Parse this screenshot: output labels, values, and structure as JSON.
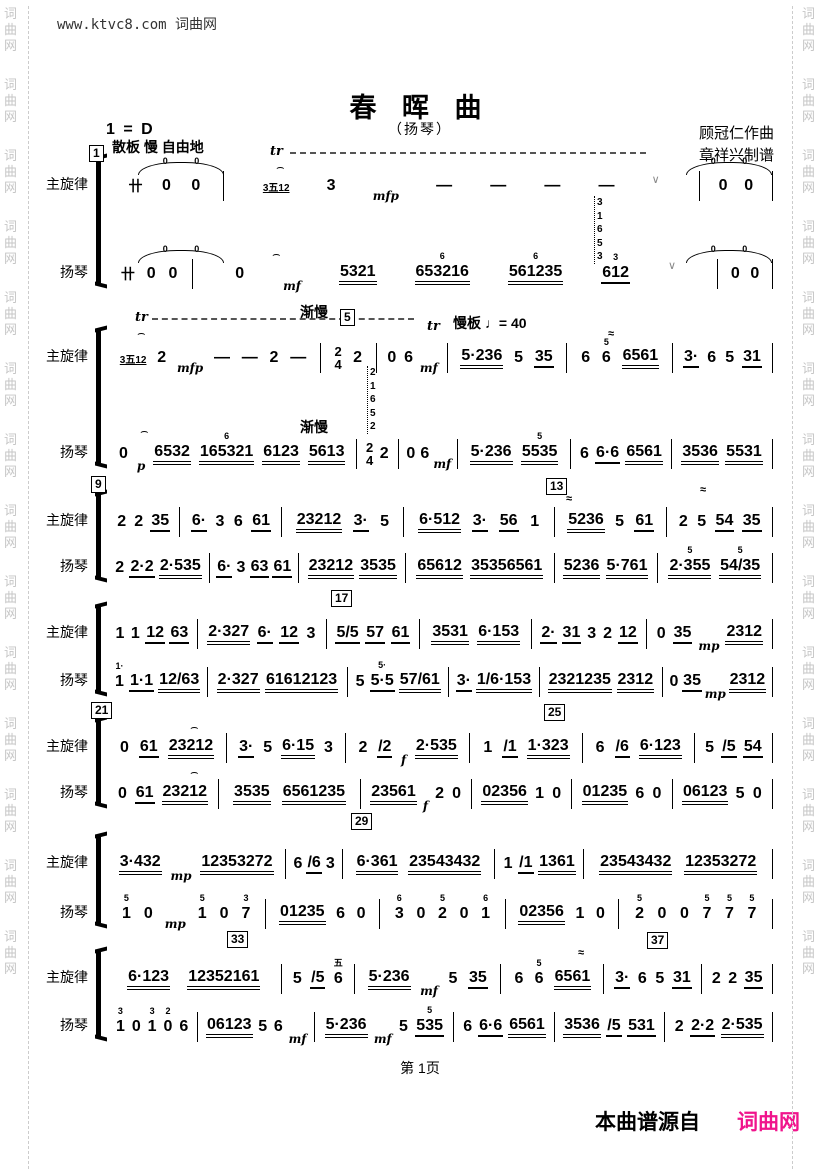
{
  "header": {
    "site_url": "www.ktvc8.com 词曲网",
    "title": "春 晖 曲",
    "subtitle": "（扬琴）",
    "composer": "顾冠仁作曲",
    "arranger": "章祥兴制谱",
    "key_signature": "1 = D"
  },
  "watermark": {
    "text": "词曲网"
  },
  "parts": {
    "top": "主旋律",
    "bottom": "扬琴"
  },
  "systems": [
    {
      "top": [
        "卄 0 0",
        "G:3五12 3 mfp — — — — ∨",
        "0 0"
      ],
      "bottom": [
        "卄 0 0",
        "0 mf 5321 653216^6 561235^6 612^3 ∨",
        "0 0"
      ]
    },
    {
      "top": [
        "G:3五12 2 mfp — — 2 —",
        "TS:2/4 2",
        "0 6 mf",
        "5·236 5 35",
        "6 6^5 6561",
        "3· 6 5 31"
      ],
      "bottom": [
        "0 p 6532 165321^6 6123 5613",
        "TS:2/4 2",
        "0 6 mf",
        "5·236 5535^5",
        "6 6·6 6561",
        "3536 5531"
      ]
    },
    {
      "top": [
        "2 2 35",
        "6· 3 6 61",
        "23212 3· 5",
        "6·512 3· 56 1",
        "5236 5 61",
        "2 5 54 35"
      ],
      "bottom": [
        "2 2·2 2·535",
        "6· 3 63 61",
        "23212 3535",
        "65612 35356561",
        "5236 5·761",
        "2·355^5 54/35^5"
      ]
    },
    {
      "top": [
        "1 1 12 63",
        "2·327 6· 12 3",
        "5/5 57 61",
        "3531 6·153",
        "2· 31 3 2 12",
        "0 35 mp 2312"
      ],
      "bottom": [
        "1^1· 1·1 12/63",
        "2·327 61612123",
        "5 5·5^5· 57/61",
        "3· 1/6·153",
        "2321235 2312",
        "0 35 mp 2312"
      ]
    },
    {
      "top": [
        "0 61 23212",
        "3· 5 6·15 3",
        "2 /2 f 2·535",
        "1 /1 1·323",
        "6 /6 6·123",
        "5 /5 54"
      ],
      "bottom": [
        "0 61 23212",
        "3535 6561235",
        "23561 f 2 0",
        "02356 1 0",
        "01235 6 0",
        "06123 5 0"
      ]
    },
    {
      "top": [
        "3·432 mp 12353272",
        "6 /6 3",
        "6·361 23543432",
        "1 /1 1361",
        "23543432 12353272"
      ],
      "bottom": [
        "1^5 0 mp 1^5 0 7^3",
        "01235 6 0",
        "3^6 0 2^5 0 1^6",
        "02356 1 0",
        "2^5 0 0 7^5 7^5 7^5"
      ]
    },
    {
      "top": [
        "6·123 12352161",
        "5 /5 6^五",
        "5·236 mf 5 35",
        "6 6^5 6561",
        "3· 6 5 31",
        "2 2 35"
      ],
      "bottom": [
        "1^3 0 1^3 0^2 6",
        "06123 5 6 mf",
        "5·236 mf 5 535^5",
        "6 6·6 6561",
        "3536 /5 531",
        "2 2·2 2·535"
      ]
    }
  ],
  "marks": [
    {
      "cls": "box",
      "t": "1",
      "x": 89,
      "y": 145
    },
    {
      "cls": "tempo",
      "t": "散板 慢 自由地",
      "x": 112,
      "y": 137
    },
    {
      "cls": "tr",
      "t": "tr",
      "x": 270,
      "y": 144
    },
    {
      "cls": "wavy",
      "t": "",
      "x": 290,
      "y": 152,
      "w": 356
    },
    {
      "cls": "ferm",
      "t": "⌢",
      "x": 276,
      "y": 159
    },
    {
      "cls": "ferm",
      "t": "⌢",
      "x": 272,
      "y": 246
    },
    {
      "cls": "htie",
      "t": "0 0",
      "x": 138,
      "y": 162
    },
    {
      "cls": "htie",
      "t": "0 0",
      "x": 138,
      "y": 250
    },
    {
      "cls": "htie",
      "t": "0 0",
      "x": 686,
      "y": 162
    },
    {
      "cls": "htie",
      "t": "0 0",
      "x": 686,
      "y": 250
    },
    {
      "cls": "arp",
      "t": "31653",
      "x": 594,
      "y": 196
    },
    {
      "cls": "tr",
      "t": "tr",
      "x": 135,
      "y": 310
    },
    {
      "cls": "wavy",
      "t": "",
      "x": 152,
      "y": 318,
      "w": 262
    },
    {
      "cls": "tempo",
      "t": "渐慢",
      "x": 300,
      "y": 302
    },
    {
      "cls": "box",
      "t": "5",
      "x": 340,
      "y": 309
    },
    {
      "cls": "ferm",
      "t": "⌢",
      "x": 137,
      "y": 325
    },
    {
      "cls": "ferm",
      "t": "⌢",
      "x": 140,
      "y": 423
    },
    {
      "cls": "tempo",
      "t": "渐慢",
      "x": 300,
      "y": 417
    },
    {
      "cls": "arp",
      "t": "21652",
      "x": 367,
      "y": 366
    },
    {
      "cls": "tr",
      "t": "tr",
      "x": 427,
      "y": 319
    },
    {
      "cls": "tempo",
      "t": "慢板 ♩= 40",
      "x": 453,
      "y": 313
    },
    {
      "cls": "mord",
      "t": "≈",
      "x": 608,
      "y": 328
    },
    {
      "cls": "box",
      "t": "9",
      "x": 91,
      "y": 476
    },
    {
      "cls": "box",
      "t": "13",
      "x": 546,
      "y": 478
    },
    {
      "cls": "mord",
      "t": "≈",
      "x": 566,
      "y": 493
    },
    {
      "cls": "mord",
      "t": "≈",
      "x": 700,
      "y": 484
    },
    {
      "cls": "box",
      "t": "17",
      "x": 331,
      "y": 590
    },
    {
      "cls": "box",
      "t": "21",
      "x": 91,
      "y": 702
    },
    {
      "cls": "box",
      "t": "25",
      "x": 544,
      "y": 704
    },
    {
      "cls": "ferm",
      "t": "⌢",
      "x": 190,
      "y": 719
    },
    {
      "cls": "ferm",
      "t": "⌢",
      "x": 190,
      "y": 764
    },
    {
      "cls": "box",
      "t": "29",
      "x": 351,
      "y": 813
    },
    {
      "cls": "box",
      "t": "33",
      "x": 227,
      "y": 931
    },
    {
      "cls": "box",
      "t": "37",
      "x": 647,
      "y": 932
    },
    {
      "cls": "mord",
      "t": "≈",
      "x": 578,
      "y": 947
    }
  ],
  "footer": {
    "page_label": "第 1页",
    "source_prefix": "本曲谱源自",
    "brand": "词曲网",
    "brand_color": "#f0148c"
  }
}
